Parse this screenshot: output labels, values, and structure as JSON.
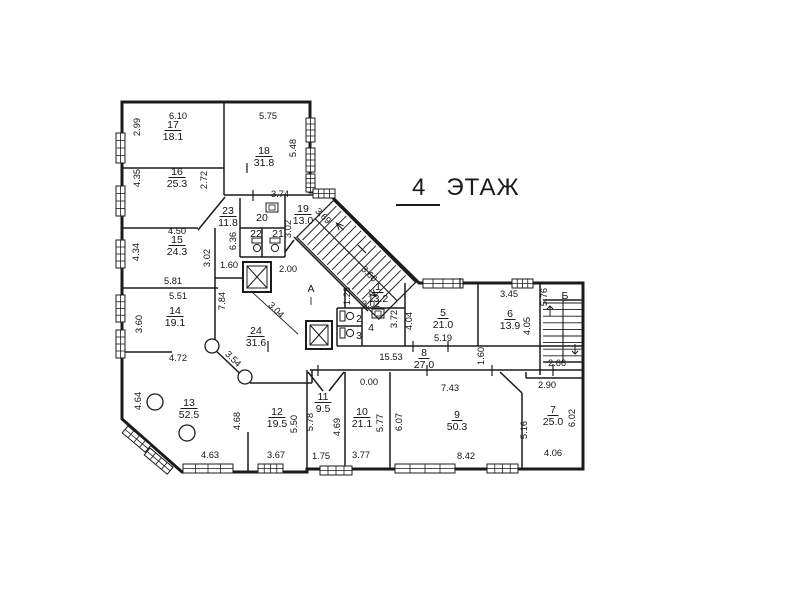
{
  "title": {
    "number": "4",
    "word": "ЭТАЖ"
  },
  "plan": {
    "rooms": [
      {
        "num": "17",
        "area": "18.1",
        "x": 173,
        "y": 128
      },
      {
        "num": "18",
        "area": "31.8",
        "x": 264,
        "y": 154
      },
      {
        "num": "16",
        "area": "25.3",
        "x": 177,
        "y": 175
      },
      {
        "num": "15",
        "area": "24.3",
        "x": 177,
        "y": 243
      },
      {
        "num": "14",
        "area": "19.1",
        "x": 175,
        "y": 314
      },
      {
        "num": "13",
        "area": "52.5",
        "x": 189,
        "y": 406
      },
      {
        "num": "12",
        "area": "19.5",
        "x": 277,
        "y": 415
      },
      {
        "num": "11",
        "area": "9.5",
        "x": 323,
        "y": 400
      },
      {
        "num": "10",
        "area": "21.1",
        "x": 362,
        "y": 415
      },
      {
        "num": "9",
        "area": "50.3",
        "x": 457,
        "y": 418
      },
      {
        "num": "7",
        "area": "25.0",
        "x": 553,
        "y": 413
      },
      {
        "num": "8",
        "area": "27.0",
        "x": 424,
        "y": 356
      },
      {
        "num": "5",
        "area": "21.0",
        "x": 443,
        "y": 316
      },
      {
        "num": "6",
        "area": "13.9",
        "x": 510,
        "y": 317
      },
      {
        "num": "1",
        "area": "13.2",
        "x": 378,
        "y": 290
      },
      {
        "num": "19",
        "area": "13.0",
        "x": 303,
        "y": 212
      },
      {
        "num": "23",
        "area": "11.8",
        "x": 228,
        "y": 214
      },
      {
        "num": "24",
        "area": "31.6",
        "x": 256,
        "y": 334
      }
    ],
    "cells": [
      {
        "t": "20",
        "x": 262,
        "y": 221
      },
      {
        "t": "22",
        "x": 256,
        "y": 237
      },
      {
        "t": "21",
        "x": 278,
        "y": 237
      },
      {
        "t": "2",
        "x": 359,
        "y": 322
      },
      {
        "t": "3",
        "x": 359,
        "y": 339
      },
      {
        "t": "4",
        "x": 371,
        "y": 331
      },
      {
        "t": "А",
        "x": 311,
        "y": 292
      },
      {
        "t": "Б",
        "x": 565,
        "y": 299
      }
    ],
    "dims": [
      {
        "v": "6.10",
        "x": 178,
        "y": 119,
        "r": 0
      },
      {
        "v": "5.75",
        "x": 268,
        "y": 119,
        "r": 0
      },
      {
        "v": "2.99",
        "x": 140,
        "y": 127,
        "r": -90
      },
      {
        "v": "5.48",
        "x": 296,
        "y": 148,
        "r": -90
      },
      {
        "v": "4.35",
        "x": 140,
        "y": 178,
        "r": -90
      },
      {
        "v": "2.72",
        "x": 207,
        "y": 180,
        "r": -90
      },
      {
        "v": "3.74",
        "x": 280,
        "y": 197,
        "r": 0
      },
      {
        "v": "4.50",
        "x": 177,
        "y": 234,
        "r": 0
      },
      {
        "v": "4.34",
        "x": 139,
        "y": 252,
        "r": -90
      },
      {
        "v": "3.02",
        "x": 210,
        "y": 258,
        "r": -90
      },
      {
        "v": "6.36",
        "x": 236,
        "y": 241,
        "r": -90
      },
      {
        "v": "3.02",
        "x": 291,
        "y": 229,
        "r": -90
      },
      {
        "v": "3.69",
        "x": 321,
        "y": 218,
        "r": 45
      },
      {
        "v": "5.81",
        "x": 173,
        "y": 284,
        "r": 0
      },
      {
        "v": "5.51",
        "x": 178,
        "y": 299,
        "r": 0
      },
      {
        "v": "1.60",
        "x": 229,
        "y": 268,
        "r": 0
      },
      {
        "v": "2.00",
        "x": 288,
        "y": 272,
        "r": 0
      },
      {
        "v": "7.84",
        "x": 225,
        "y": 301,
        "r": -90
      },
      {
        "v": "3.60",
        "x": 142,
        "y": 324,
        "r": -90
      },
      {
        "v": "3.04",
        "x": 274,
        "y": 312,
        "r": 45
      },
      {
        "v": "3.54",
        "x": 231,
        "y": 361,
        "r": 45
      },
      {
        "v": "3.60",
        "x": 367,
        "y": 276,
        "r": 45
      },
      {
        "v": "1.28",
        "x": 350,
        "y": 296,
        "r": -90
      },
      {
        "v": "3.02",
        "x": 371,
        "y": 307,
        "r": 0
      },
      {
        "v": "3.72",
        "x": 397,
        "y": 319,
        "r": -90
      },
      {
        "v": "4.04",
        "x": 412,
        "y": 321,
        "r": -90
      },
      {
        "v": "5.19",
        "x": 443,
        "y": 341,
        "r": 0
      },
      {
        "v": "3.45",
        "x": 509,
        "y": 297,
        "r": 0
      },
      {
        "v": "4.05",
        "x": 530,
        "y": 326,
        "r": -90
      },
      {
        "v": "5.76",
        "x": 547,
        "y": 297,
        "r": -90
      },
      {
        "v": "15.53",
        "x": 391,
        "y": 360,
        "r": 0
      },
      {
        "v": "1.60",
        "x": 484,
        "y": 356,
        "r": -90
      },
      {
        "v": "2.66",
        "x": 557,
        "y": 366,
        "r": 0
      },
      {
        "v": "2.90",
        "x": 547,
        "y": 388,
        "r": 0
      },
      {
        "v": "0.00",
        "x": 369,
        "y": 385,
        "r": 0
      },
      {
        "v": "7.43",
        "x": 450,
        "y": 391,
        "r": 0
      },
      {
        "v": "4.72",
        "x": 178,
        "y": 361,
        "r": 0
      },
      {
        "v": "4.64",
        "x": 141,
        "y": 401,
        "r": -90
      },
      {
        "v": "4.68",
        "x": 240,
        "y": 421,
        "r": -90
      },
      {
        "v": "5.50",
        "x": 297,
        "y": 424,
        "r": -90
      },
      {
        "v": "5.78",
        "x": 313,
        "y": 422,
        "r": -90
      },
      {
        "v": "4.69",
        "x": 340,
        "y": 427,
        "r": -90
      },
      {
        "v": "5.77",
        "x": 383,
        "y": 423,
        "r": -90
      },
      {
        "v": "6.07",
        "x": 402,
        "y": 422,
        "r": -90
      },
      {
        "v": "5.16",
        "x": 527,
        "y": 430,
        "r": -90
      },
      {
        "v": "6.02",
        "x": 575,
        "y": 418,
        "r": -90
      },
      {
        "v": "4.63",
        "x": 210,
        "y": 458,
        "r": 0
      },
      {
        "v": "3.67",
        "x": 276,
        "y": 458,
        "r": 0
      },
      {
        "v": "1.75",
        "x": 321,
        "y": 459,
        "r": 0
      },
      {
        "v": "3.77",
        "x": 361,
        "y": 458,
        "r": 0
      },
      {
        "v": "8.42",
        "x": 466,
        "y": 459,
        "r": 0
      },
      {
        "v": "4.06",
        "x": 553,
        "y": 456,
        "r": 0
      }
    ]
  }
}
